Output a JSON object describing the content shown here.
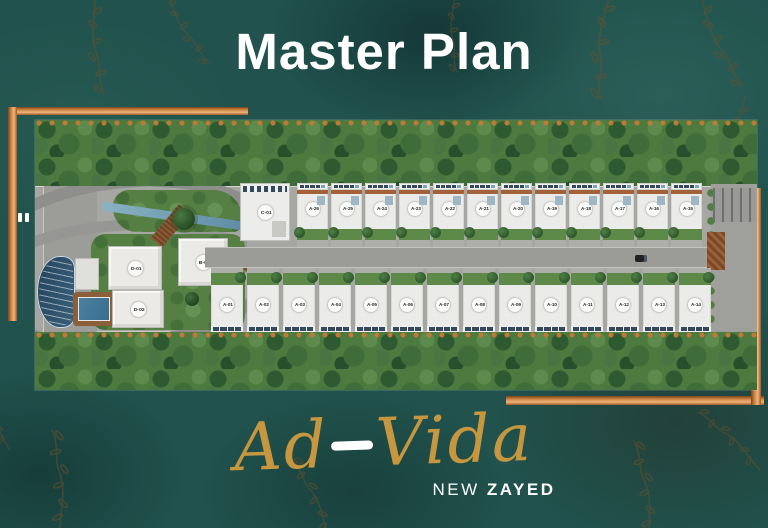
{
  "title": "Master Plan",
  "brand": {
    "name_left": "Ad",
    "name_right": "Vida",
    "subtitle_prefix": "NEW",
    "subtitle_emphasis": "ZAYED"
  },
  "master_plan": {
    "clubhouse": {
      "label": "C-01"
    },
    "cluster_buildings": [
      {
        "label": "D-01"
      },
      {
        "label": "D-02"
      },
      {
        "label": "B-01"
      }
    ],
    "top_row_villas": [
      "A-26",
      "A-25",
      "A-24",
      "A-23",
      "A-22",
      "A-21",
      "A-20",
      "A-19",
      "A-18",
      "A-17",
      "A-16",
      "A-15"
    ],
    "bottom_row_villas": [
      "A-01",
      "A-02",
      "A-03",
      "A-04",
      "A-05",
      "A-06",
      "A-07",
      "A-08",
      "A-09",
      "A-10",
      "A-11",
      "A-12",
      "A-13",
      "A-14"
    ]
  },
  "colors": {
    "background_teal": "#21524d",
    "copper_accent": "#c9833f",
    "brand_gold": "#c6973f",
    "text_white": "#ffffff",
    "foliage_green": "#4c7a3f",
    "road_gray": "#a6a6a3",
    "pool_blue": "#3f7490"
  }
}
